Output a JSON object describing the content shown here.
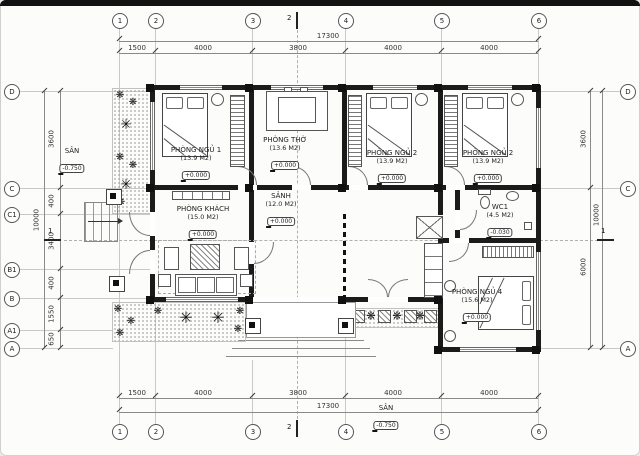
{
  "grid": {
    "top": [
      "1",
      "2",
      "3",
      "4",
      "5",
      "6"
    ],
    "bottom": [
      "1",
      "2",
      "3",
      "4",
      "5",
      "6"
    ],
    "left": [
      "D",
      "C",
      "C1",
      "B1",
      "B",
      "A1",
      "A"
    ],
    "right": [
      "D",
      "C",
      "A"
    ],
    "section_v": "2",
    "section_h": "1"
  },
  "dims": {
    "top_total": "17300",
    "top": [
      "1500",
      "4000",
      "3800",
      "4000",
      "4000"
    ],
    "bottom_total": "17300",
    "bottom": [
      "1500",
      "4000",
      "3800",
      "4000",
      "4000"
    ],
    "left_total": "10000",
    "left": [
      "3600",
      "400",
      "3400",
      "400",
      "1550",
      "650"
    ],
    "right_total": "10000",
    "right": [
      "3600",
      "6000"
    ]
  },
  "rooms": {
    "bedroom1": {
      "name": "PHÒNG NGỦ 1",
      "area": "(13.9 M2)",
      "level": "+0.000"
    },
    "worship": {
      "name": "PHÒNG THỜ",
      "area": "(13.6 M2)",
      "level": "+0.000"
    },
    "bedroom2a": {
      "name": "PHÒNG NGỦ 2",
      "area": "(13.9 M2)",
      "level": "+0.000"
    },
    "bedroom2b": {
      "name": "PHÒNG NGỦ 2",
      "area": "(13.9 M2)",
      "level": "+0.000"
    },
    "living": {
      "name": "PHÒNG KHÁCH",
      "area": "(15.0 M2)",
      "level": "+0.000"
    },
    "hall": {
      "name": "SẢNH",
      "area": "(12.0 M2)",
      "level": "+0.000"
    },
    "wc": {
      "name": "WC1",
      "area": "(4.5 M2)",
      "level": "-0.030"
    },
    "bedroom4": {
      "name": "PHÒNG NGỦ 4",
      "area": "(15.6 M2)",
      "level": "+0.000"
    }
  },
  "site": {
    "yard_left": {
      "label": "SÂN",
      "level": "-0.750"
    },
    "yard_bottom": {
      "label": "SÂN",
      "level": "-0.750"
    }
  },
  "icons": {
    "plant_large": "✳",
    "plant_small": "❋"
  }
}
